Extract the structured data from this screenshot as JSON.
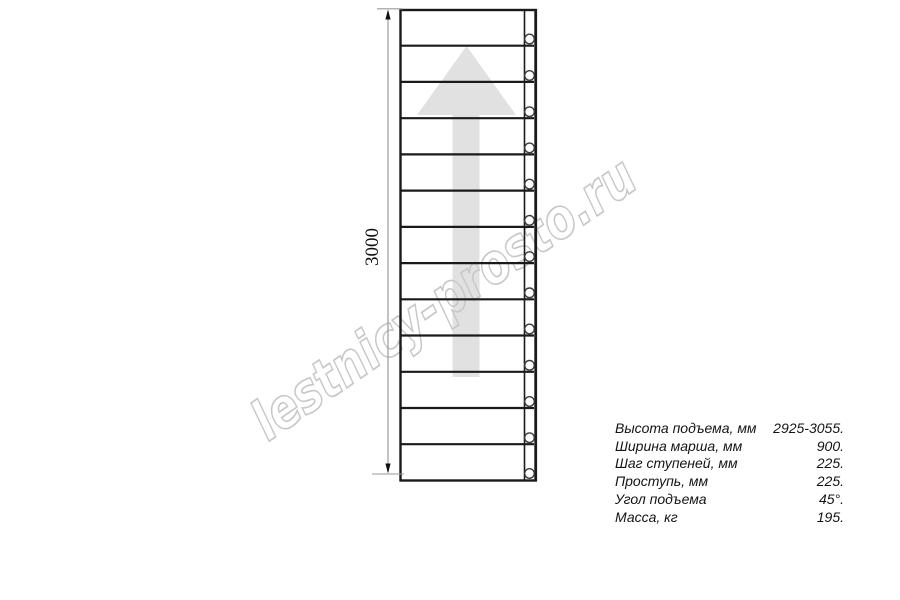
{
  "watermark": {
    "text": "lestnicy-prosto.ru",
    "color": "#c8c8c8"
  },
  "drawing": {
    "type": "ladder-plan-view",
    "step_count": 13,
    "arrow_color": "#e1e1e1",
    "line_color": "#1a1a1a",
    "dimension": {
      "label": "3000",
      "orientation": "vertical"
    }
  },
  "specs": {
    "rows": [
      {
        "label": "Высота подъема, мм",
        "value": "2925-3055."
      },
      {
        "label": "Ширина марша, мм",
        "value": "900."
      },
      {
        "label": "Шаг ступеней, мм",
        "value": "225."
      },
      {
        "label": "Проступь, мм",
        "value": "225."
      },
      {
        "label": "Угол подъема",
        "value": "45°."
      },
      {
        "label": "Масса, кг",
        "value": "195."
      }
    ]
  }
}
